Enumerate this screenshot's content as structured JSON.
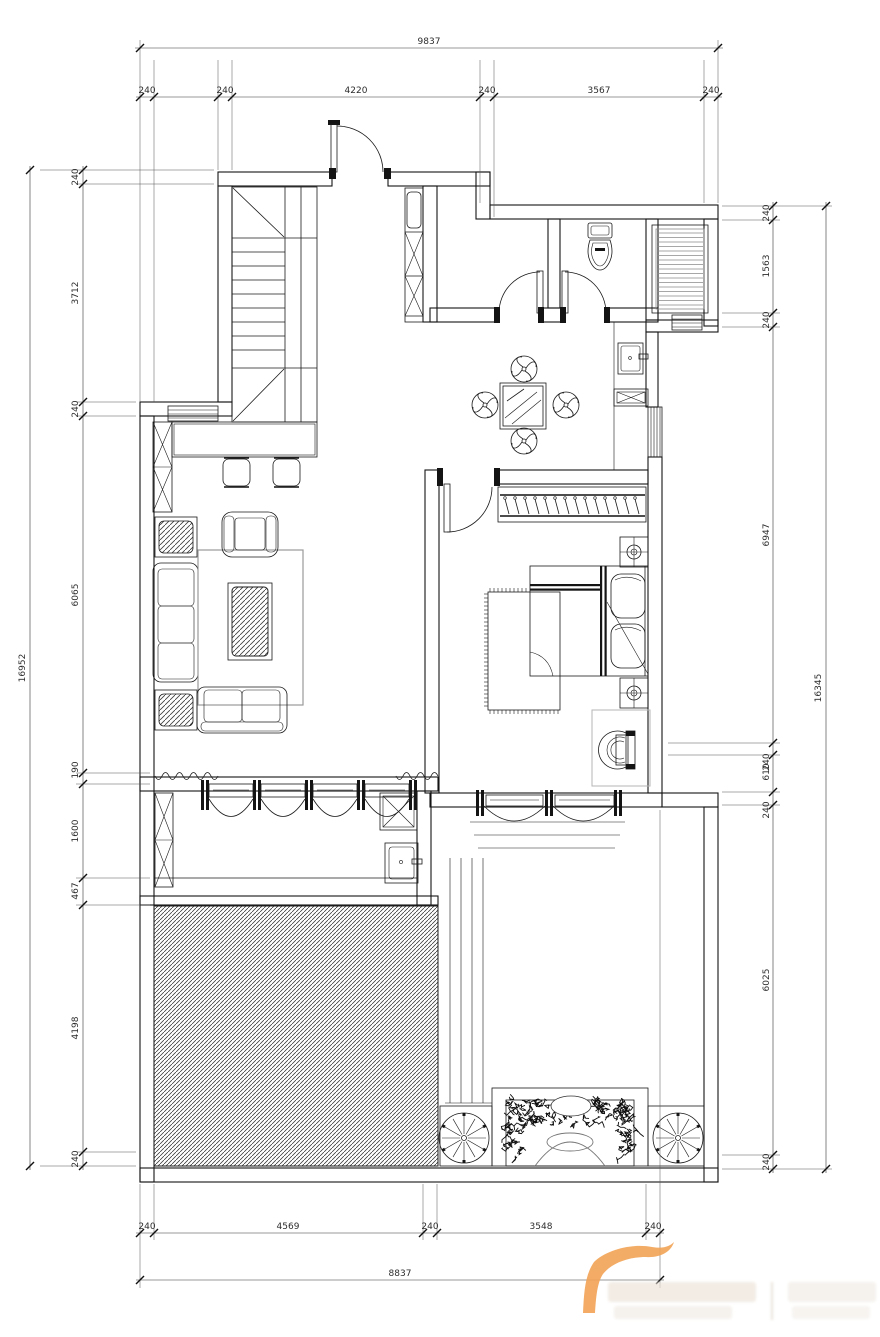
{
  "drawing": {
    "type": "architectural-floor-plan",
    "bg_color": "#ffffff",
    "line_color": "#141414",
    "watermark_color": "#f2a355",
    "dims": {
      "top": {
        "overall": "9837",
        "segments": [
          "240",
          "240",
          "4220",
          "240",
          "3567",
          "240"
        ]
      },
      "bottom": {
        "overall": "8837",
        "segments": [
          "240",
          "4569",
          "240",
          "3548",
          "240"
        ]
      },
      "left": {
        "overall": "16952",
        "segments": [
          "240",
          "3712",
          "240",
          "6065",
          "190",
          "1600",
          "467",
          "4198",
          "240"
        ]
      },
      "right": {
        "overall": "16345",
        "segments": [
          "240",
          "1563",
          "240",
          "6947",
          "240",
          "610",
          "240",
          "6025",
          "240"
        ]
      }
    }
  }
}
